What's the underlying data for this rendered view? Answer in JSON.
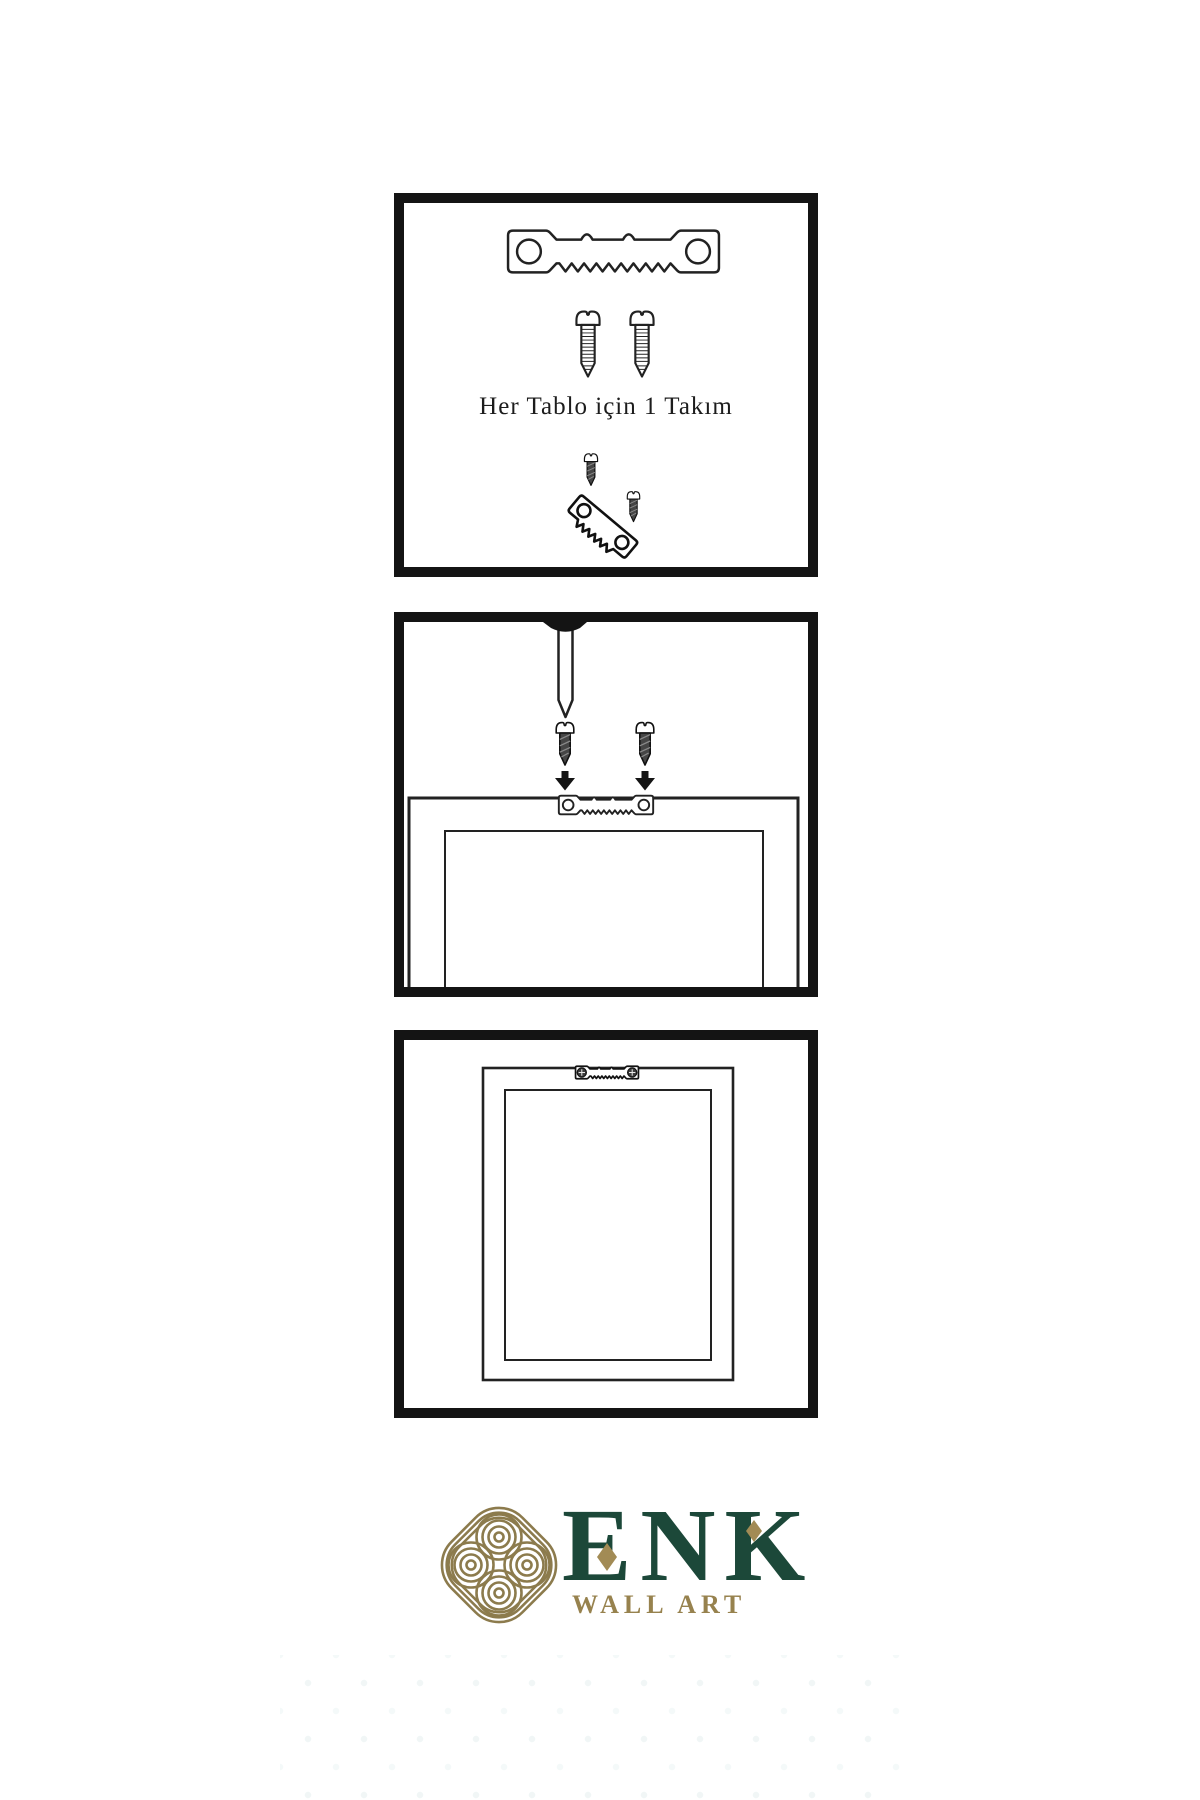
{
  "document": {
    "background": "#ffffff",
    "type": "wall-art hanging hardware instruction sheet"
  },
  "panel1": {
    "caption": "Her Tablo için 1 Takım",
    "icons": [
      "sawtooth-hanger-icon",
      "screw-icon",
      "screw-icon",
      "mini-mounting-illustration"
    ]
  },
  "panel2": {
    "icons": [
      "wall-nail-icon",
      "screw-icon",
      "screw-icon",
      "arrow-down-icon",
      "arrow-down-icon",
      "sawtooth-hanger-icon",
      "picture-frame-icon"
    ]
  },
  "panel3": {
    "icons": [
      "picture-frame-icon",
      "mounted-sawtooth-hanger-icon"
    ]
  },
  "logo": {
    "brand": "ENK",
    "subtitle": "WALL ART",
    "icons": [
      "interlocked-knot-icon",
      "diamond-ornament-icon",
      "diamond-ornament-icon"
    ]
  },
  "colors": {
    "panel_border": "#141414",
    "line": "#222222",
    "screw_dark_fill": "#454545",
    "brand_green": "#1c4839",
    "brand_gold": "#97824e",
    "knot_gold": "#8c7b4d",
    "ornament_gold": "#a28b55"
  }
}
